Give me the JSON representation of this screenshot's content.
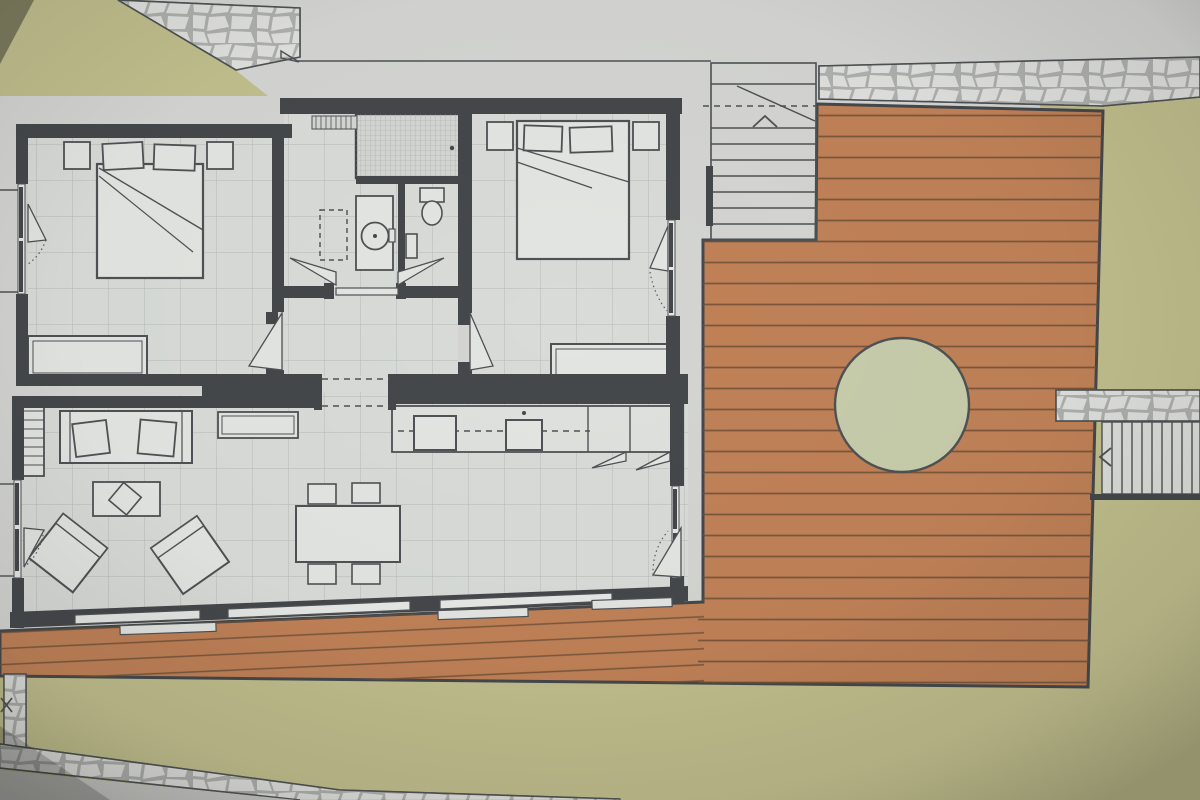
{
  "meta": {
    "kind": "architectural-floor-plan-photo",
    "description": "photographed color floor plan of a small house with two bedrooms, bathroom, open living-dining-kitchen, large wooden deck with round tree cut-out, garden lawn areas, stone footpaths and two exterior stairs",
    "visible_text": "none"
  },
  "colors": {
    "paper": "#d4d5d2",
    "paperDark": "#c7c8c5",
    "olive": "#c1bf8d",
    "sage": "#c7ccab",
    "deck": "#c08157",
    "plank": "#6d5037",
    "stoneBg": "#dcdeda",
    "stoneJoint": "#a9aba8",
    "stoneCell": "#dfe0dd",
    "floor": "#d8dbd8",
    "grid": "#b5bbb7",
    "wall": "#44484b",
    "line": "#4e5254",
    "fixture": "#e3e5e2",
    "mosaic": "#a7aca9"
  },
  "scene": {
    "garden": {
      "areas": [
        "top-left-lawn",
        "east-lawn",
        "south-lawn"
      ]
    },
    "deck": {
      "tree_cutout": true,
      "plank_direction": "horizontal"
    },
    "stairs": [
      {
        "name": "entrance-stairs",
        "location": "top-center",
        "treads": 8,
        "break_line": true,
        "direction_mark": "chevron-up"
      },
      {
        "name": "garden-stairs",
        "location": "right-middle",
        "treads": 10,
        "direction_mark": "chevron-left"
      }
    ],
    "stone_paths": [
      "top-left",
      "top-right",
      "right-middle",
      "bottom-left-strip",
      "bottom-left-diagonal"
    ],
    "rooms": [
      {
        "name": "bedroom-1",
        "furniture": [
          "double-bed",
          "two-nightstands",
          "wardrobe"
        ],
        "windows": 1,
        "doors": 1
      },
      {
        "name": "bathroom",
        "furniture": [
          "shower",
          "vanity-basin",
          "toilet",
          "washing-machine-dashed"
        ],
        "doors": 1
      },
      {
        "name": "bedroom-2",
        "furniture": [
          "double-bed",
          "two-nightstands",
          "sideboard"
        ],
        "windows": 1,
        "doors": 1
      },
      {
        "name": "hallway",
        "marks": [
          "dashed-beam-lines"
        ]
      },
      {
        "name": "living-dining-kitchen",
        "furniture": [
          "bookshelf",
          "sofa",
          "two-cushions",
          "tv-sideboard",
          "coffee-table",
          "two-armchairs",
          "dining-table",
          "four-chairs",
          "kitchen-counter",
          "two-appliances"
        ],
        "windows": "large-south-glazing",
        "doors": 1
      }
    ]
  }
}
